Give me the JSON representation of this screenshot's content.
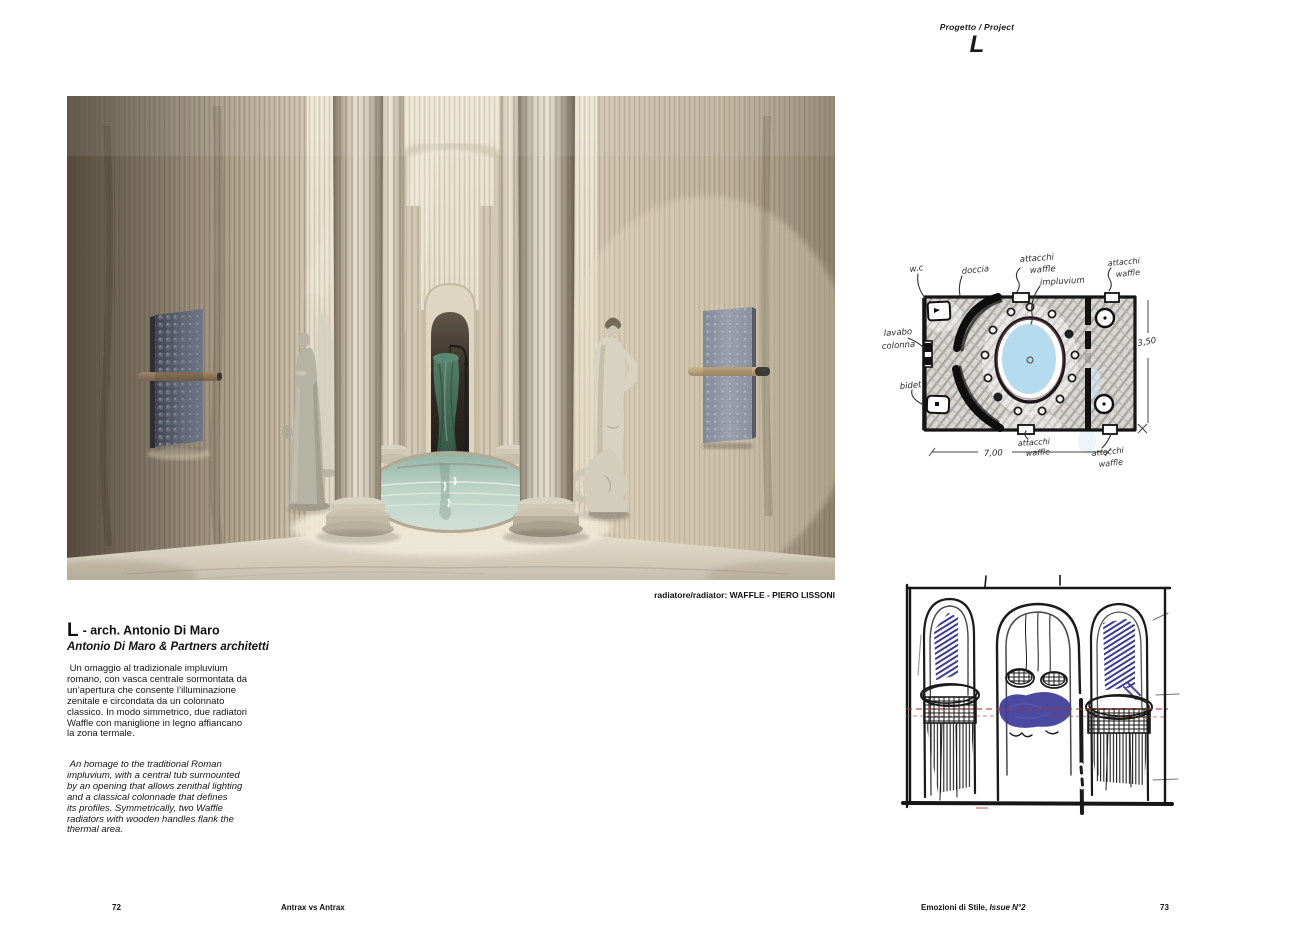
{
  "header": {
    "kicker": "Progetto / Project",
    "letter": "L"
  },
  "article": {
    "title_letter": "L",
    "title_rest": " - arch. Antonio Di Maro",
    "subtitle": "Antonio Di Maro & Partners architetti",
    "caption": "radiatore/radiator: WAFFLE - PIERO LISSONI",
    "body_it": [
      " Un omaggio al tradizionale impluvium",
      "romano, con vasca centrale sormontata da",
      "un’apertura che consente l’illuminazione",
      "zenitale e circondata da un colonnato",
      "classico. In modo simmetrico, due radiatori",
      "Waffle con maniglione in legno affiancano",
      "la zona termale."
    ],
    "body_en": [
      " An homage to the traditional Roman",
      "impluvium, with a central tub surmounted",
      "by an opening that allows zenithal lighting",
      "and a classical colonnade that defines",
      "its profiles. Symmetrically, two Waffle",
      "radiators with wooden handles flank the",
      "thermal area."
    ]
  },
  "plan_sketch": {
    "labels": {
      "wc": "w.c",
      "doccia": "doccia",
      "attacchi": "attacchi",
      "waffle": "waffle",
      "impluvium": "impluvium",
      "lavabo": "lavabo",
      "colonna": "colonna",
      "bidet": "bidet"
    },
    "dimensions": {
      "width": "7,00",
      "height": "3,50"
    }
  },
  "footer": {
    "left_page": "72",
    "left_title": "Antrax vs Antrax",
    "right_title": "Emozioni di Stile, ",
    "right_title_italic": "Issue N°2",
    "right_page": "73"
  },
  "colors": {
    "sketch_ink": "#1a1a1a",
    "sketch_blue": "#3c3a99",
    "sketch_red": "#a63a30",
    "plan_water_blue": "#b7dbee",
    "photo_water_teal": "#bad2c6",
    "radiator_slate": "#555b6b",
    "wood_handle": "#9a8165",
    "marble_beige": "#c9bda7",
    "pedestal_green": "#3f6a57"
  }
}
